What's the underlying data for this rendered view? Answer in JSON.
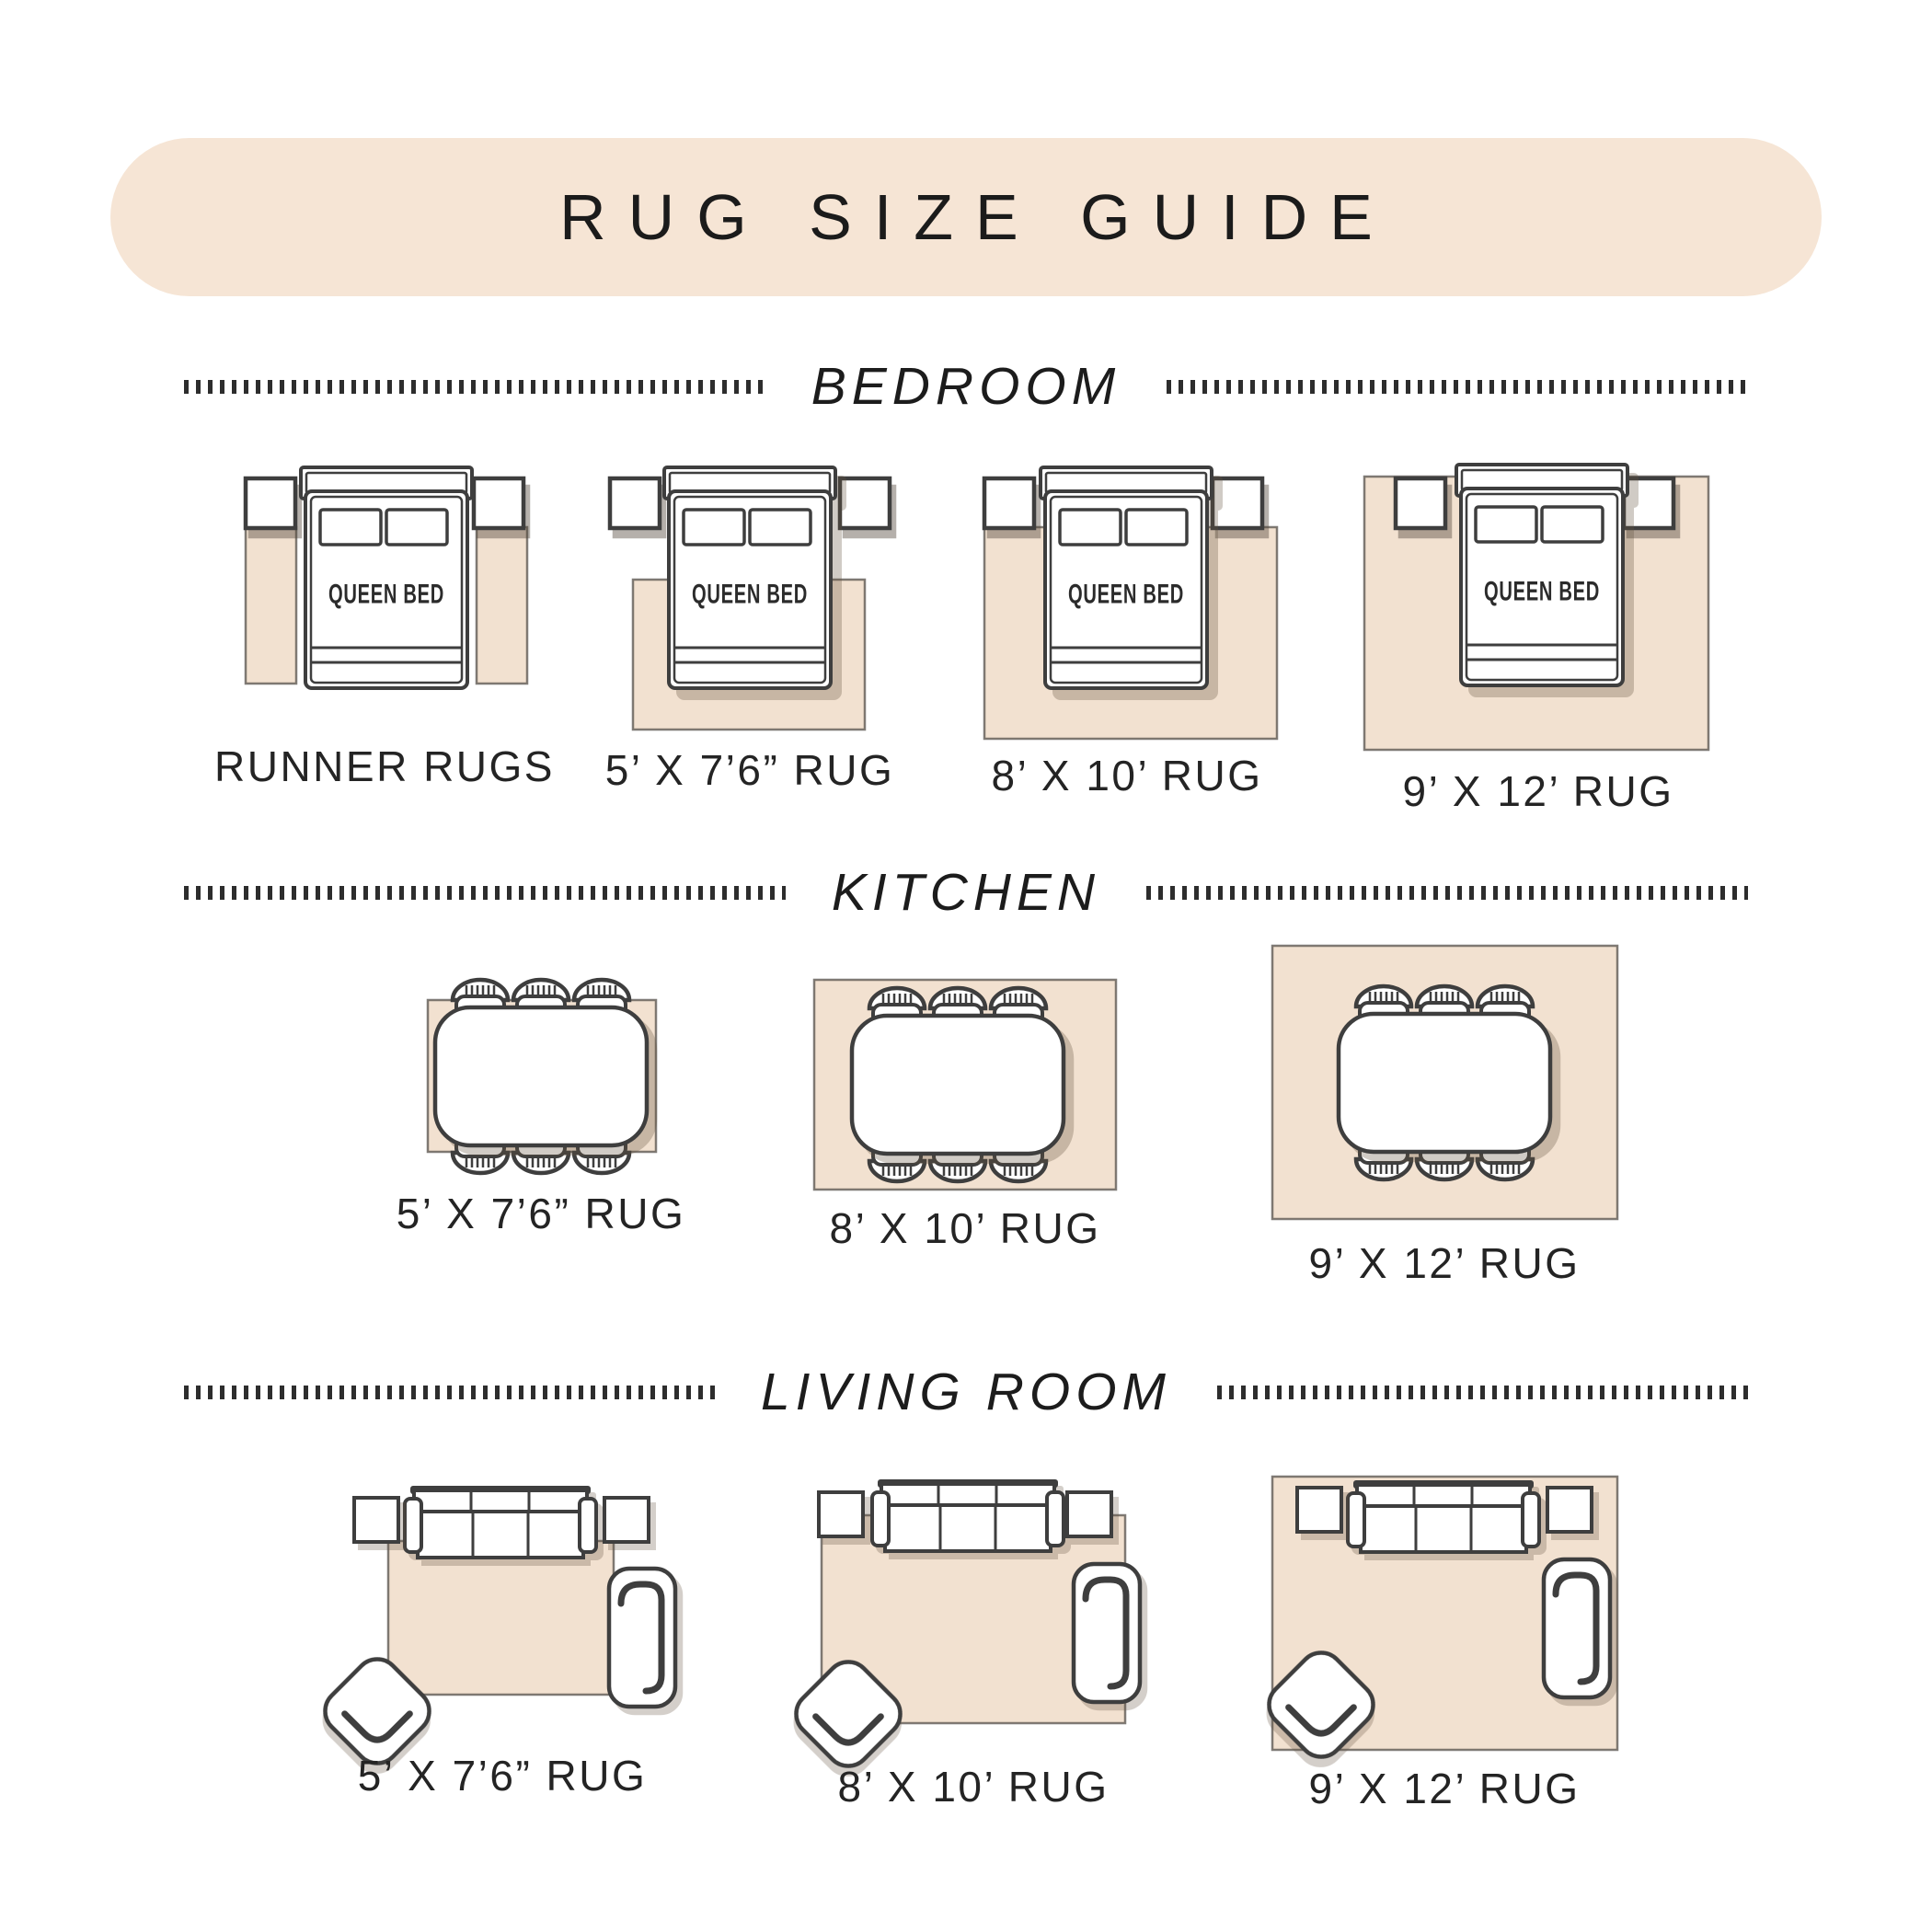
{
  "title": "RUG SIZE GUIDE",
  "colors": {
    "banner": "#f6e5d5",
    "rug": "#f2e1d0",
    "outline": "#3e3e3e",
    "ink": "#1f1f1f"
  },
  "furniture": {
    "bed": "QUEEN BED"
  },
  "sections": [
    {
      "name": "BEDROOM",
      "items": [
        {
          "label": "RUNNER RUGS"
        },
        {
          "label": "5’ X 7’6” RUG"
        },
        {
          "label": "8’ X 10’ RUG"
        },
        {
          "label": "9’ X 12’ RUG"
        }
      ]
    },
    {
      "name": "KITCHEN",
      "items": [
        {
          "label": "5’ X 7’6” RUG"
        },
        {
          "label": "8’ X 10’ RUG"
        },
        {
          "label": "9’ X 12’ RUG"
        }
      ]
    },
    {
      "name": "LIVING ROOM",
      "items": [
        {
          "label": "5’ X 7’6” RUG"
        },
        {
          "label": "8’ X 10’ RUG"
        },
        {
          "label": "9’ X 12’ RUG"
        }
      ]
    }
  ]
}
